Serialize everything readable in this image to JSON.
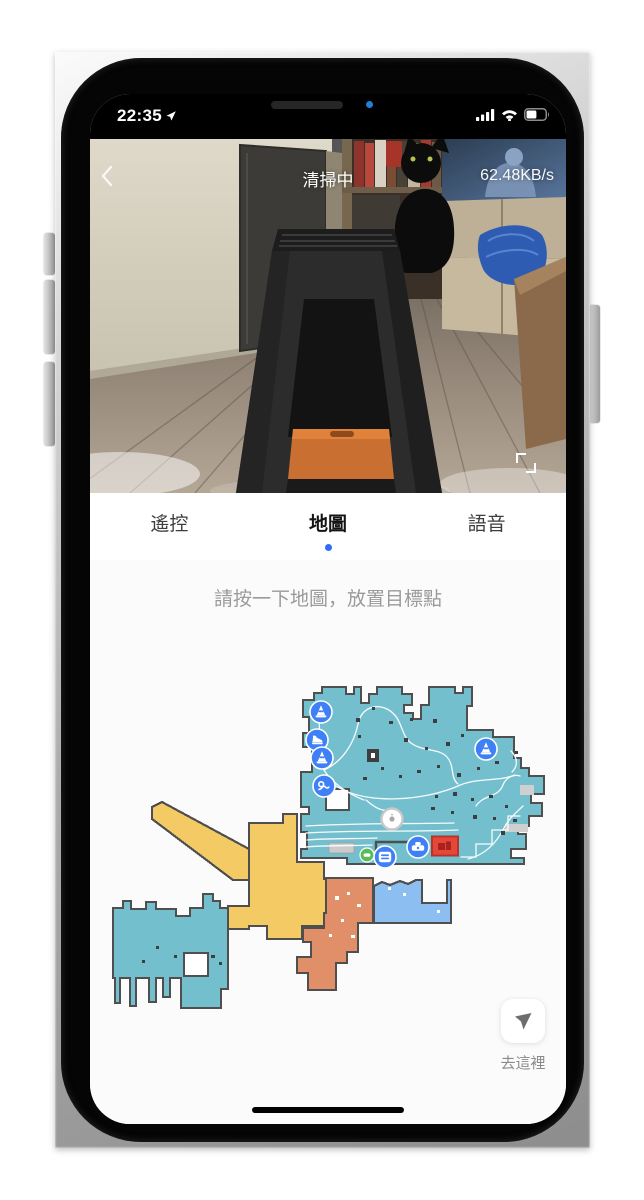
{
  "status_bar": {
    "time": "22:35",
    "battery_level": 0.55
  },
  "video": {
    "title": "清掃中",
    "bitrate": "62.48KB/s",
    "shelf_box_label": "7"
  },
  "tab_bar": {
    "tabs": [
      {
        "label": "遙控"
      },
      {
        "label": "地圖"
      },
      {
        "label": "語音"
      }
    ],
    "active_index": 1,
    "active_dot_color": "#2e6ef2"
  },
  "map_hint": "請按一下地圖，放置目標點",
  "map": {
    "colors": {
      "room_teal": "#73bfce",
      "room_yellow": "#f3ca63",
      "room_orange": "#e18f68",
      "room_blue": "#8cbef2",
      "wall": "#4f4f4f",
      "marker_blue": "#3f80f6",
      "no_go_red": "#e5483b",
      "dock_green": "#56bd58",
      "trace_white": "#ffffff"
    },
    "markers": [
      {
        "type": "cone",
        "x": 315,
        "y": 706
      },
      {
        "type": "shoe",
        "x": 311,
        "y": 734
      },
      {
        "type": "cone",
        "x": 316,
        "y": 752
      },
      {
        "type": "wire",
        "x": 318,
        "y": 780
      },
      {
        "type": "cone",
        "x": 480,
        "y": 743
      },
      {
        "type": "no-go-zone",
        "x": 439,
        "y": 840
      },
      {
        "type": "robot",
        "x": 386,
        "y": 813
      },
      {
        "type": "dock",
        "x": 412,
        "y": 841
      },
      {
        "type": "stripes",
        "x": 379,
        "y": 851
      },
      {
        "type": "dock-green",
        "x": 361,
        "y": 849
      }
    ]
  },
  "goto_button": {
    "label": "去這裡"
  }
}
